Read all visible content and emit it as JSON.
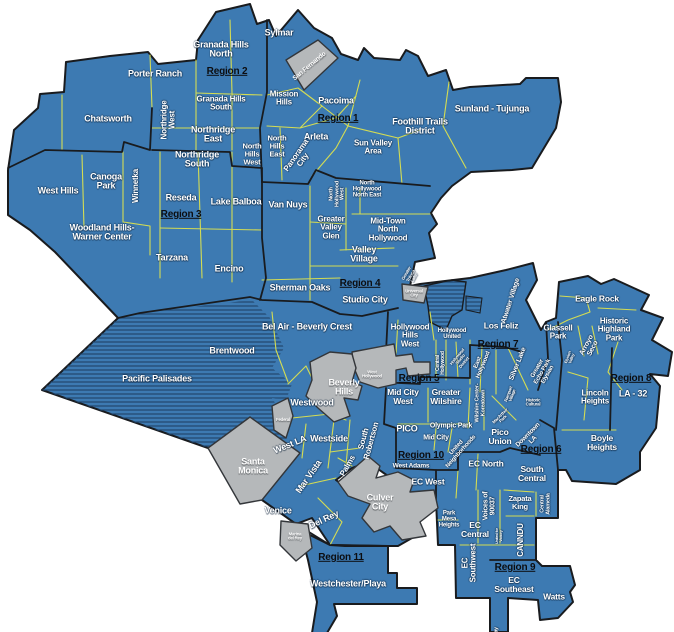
{
  "map": {
    "title": "Los Angeles Neighborhood Councils Region Map",
    "colors": {
      "land": "#3d7ab2",
      "hatch_line": "#22466d",
      "city_boundary": "#191b1e",
      "council_line": "#dde24e",
      "other_city_fill": "#b5b8ba",
      "other_city_stroke": "#33363a",
      "area_label": "#ffffff",
      "region_label": "#0c0d10"
    },
    "labels": [
      {
        "id": "sylmar",
        "text": "Sylmar",
        "x": 279,
        "y": 33,
        "rot": 0,
        "size": 9,
        "style": "area"
      },
      {
        "id": "granada-hills-north",
        "text": "Granada Hills\nNorth",
        "x": 221,
        "y": 50,
        "rot": 0,
        "size": 9,
        "style": "area"
      },
      {
        "id": "region-2",
        "text": "Region 2",
        "x": 227,
        "y": 72,
        "rot": 0,
        "size": 10,
        "style": "region"
      },
      {
        "id": "porter-ranch",
        "text": "Porter Ranch",
        "x": 155,
        "y": 74,
        "rot": 0,
        "size": 9,
        "style": "area"
      },
      {
        "id": "granada-hills-south",
        "text": "Granada Hills\nSouth",
        "x": 221,
        "y": 104,
        "rot": 0,
        "size": 8,
        "style": "area"
      },
      {
        "id": "mission-hills",
        "text": "Mission\nHills",
        "x": 284,
        "y": 99,
        "rot": 0,
        "size": 8,
        "style": "area"
      },
      {
        "id": "chatsworth",
        "text": "Chatsworth",
        "x": 108,
        "y": 119,
        "rot": 0,
        "size": 9,
        "style": "area"
      },
      {
        "id": "northridge-west",
        "text": "Northridge\nWest",
        "x": 169,
        "y": 120,
        "rot": -90,
        "size": 8,
        "style": "area"
      },
      {
        "id": "northridge-east",
        "text": "Northridge\nEast",
        "x": 213,
        "y": 135,
        "rot": 0,
        "size": 9,
        "style": "area"
      },
      {
        "id": "northridge-south",
        "text": "Northridge\nSouth",
        "x": 197,
        "y": 160,
        "rot": 0,
        "size": 9,
        "style": "area"
      },
      {
        "id": "north-hills-west",
        "text": "North\nHills\nWest",
        "x": 252,
        "y": 154,
        "rot": 0,
        "size": 7.5,
        "style": "area"
      },
      {
        "id": "north-hills-east",
        "text": "North\nHills\nEast",
        "x": 277,
        "y": 146,
        "rot": 0,
        "size": 7.5,
        "style": "area"
      },
      {
        "id": "arleta",
        "text": "Arleta",
        "x": 316,
        "y": 137,
        "rot": 0,
        "size": 9,
        "style": "area"
      },
      {
        "id": "panorama-city",
        "text": "Panorama\nCity",
        "x": 300,
        "y": 158,
        "rot": -55,
        "size": 8,
        "style": "area"
      },
      {
        "id": "pacoima",
        "text": "Pacoima",
        "x": 336,
        "y": 101,
        "rot": 0,
        "size": 9,
        "style": "area"
      },
      {
        "id": "region-1",
        "text": "Region 1",
        "x": 338,
        "y": 119,
        "rot": 0,
        "size": 10,
        "style": "region"
      },
      {
        "id": "sun-valley-area",
        "text": "Sun Valley\nArea",
        "x": 373,
        "y": 148,
        "rot": 0,
        "size": 8,
        "style": "area"
      },
      {
        "id": "foothill-trails-district",
        "text": "Foothill Trails\nDistrict",
        "x": 420,
        "y": 127,
        "rot": 0,
        "size": 9,
        "style": "area"
      },
      {
        "id": "sunland-tujunga",
        "text": "Sunland - Tujunga",
        "x": 492,
        "y": 109,
        "rot": 0,
        "size": 9,
        "style": "area"
      },
      {
        "id": "san-fernando",
        "text": "San Fernando",
        "x": 310,
        "y": 67,
        "rot": -40,
        "size": 6.5,
        "style": "city"
      },
      {
        "id": "west-hills",
        "text": "West Hills",
        "x": 58,
        "y": 191,
        "rot": 0,
        "size": 9,
        "style": "area"
      },
      {
        "id": "canoga-park",
        "text": "Canoga\nPark",
        "x": 106,
        "y": 182,
        "rot": 0,
        "size": 9,
        "style": "area"
      },
      {
        "id": "winnetka",
        "text": "Winnetka",
        "x": 136,
        "y": 186,
        "rot": -90,
        "size": 8,
        "style": "area"
      },
      {
        "id": "reseda",
        "text": "Reseda",
        "x": 181,
        "y": 198,
        "rot": 0,
        "size": 9,
        "style": "area"
      },
      {
        "id": "region-3",
        "text": "Region 3",
        "x": 181,
        "y": 215,
        "rot": 0,
        "size": 10,
        "style": "region"
      },
      {
        "id": "lake-balboa",
        "text": "Lake Balboa",
        "x": 236,
        "y": 202,
        "rot": 0,
        "size": 9,
        "style": "area"
      },
      {
        "id": "van-nuys",
        "text": "Van Nuys",
        "x": 288,
        "y": 205,
        "rot": 0,
        "size": 9,
        "style": "area"
      },
      {
        "id": "woodland-hills-warner-center",
        "text": "Woodland Hills-\nWarner Center",
        "x": 102,
        "y": 233,
        "rot": 0,
        "size": 9,
        "style": "area"
      },
      {
        "id": "tarzana",
        "text": "Tarzana",
        "x": 172,
        "y": 258,
        "rot": 0,
        "size": 9,
        "style": "area"
      },
      {
        "id": "encino",
        "text": "Encino",
        "x": 229,
        "y": 269,
        "rot": 0,
        "size": 9,
        "style": "area"
      },
      {
        "id": "north-hollywood-west",
        "text": "North\nHollywood\nWest",
        "x": 338,
        "y": 194,
        "rot": -90,
        "size": 5.5,
        "style": "area"
      },
      {
        "id": "north-hollywood-north-east",
        "text": "North\nHollywood\nNorth East",
        "x": 367,
        "y": 190,
        "rot": 0,
        "size": 6,
        "style": "area"
      },
      {
        "id": "greater-valley-glen",
        "text": "Greater\nValley\nGlen",
        "x": 331,
        "y": 228,
        "rot": 0,
        "size": 8,
        "style": "area"
      },
      {
        "id": "mid-town-north-hollywood",
        "text": "Mid-Town\nNorth\nHollywood",
        "x": 388,
        "y": 230,
        "rot": 0,
        "size": 8,
        "style": "area"
      },
      {
        "id": "valley-village",
        "text": "Valley\nVillage",
        "x": 364,
        "y": 255,
        "rot": 0,
        "size": 9,
        "style": "area"
      },
      {
        "id": "region-4",
        "text": "Region 4",
        "x": 360,
        "y": 284,
        "rot": 0,
        "size": 10,
        "style": "region"
      },
      {
        "id": "studio-city",
        "text": "Studio City",
        "x": 365,
        "y": 300,
        "rot": 0,
        "size": 9,
        "style": "area"
      },
      {
        "id": "sherman-oaks",
        "text": "Sherman Oaks",
        "x": 300,
        "y": 288,
        "rot": 0,
        "size": 9,
        "style": "area"
      },
      {
        "id": "greater-toluca-lake",
        "text": "Greater\nToluca\nLake",
        "x": 411,
        "y": 276,
        "rot": -60,
        "size": 4.5,
        "style": "area"
      },
      {
        "id": "universal-city",
        "text": "Universal\nCity",
        "x": 414,
        "y": 294,
        "rot": 0,
        "size": 4.3,
        "style": "city"
      },
      {
        "id": "bel-air-beverly-crest",
        "text": "Bel Air - Beverly Crest",
        "x": 307,
        "y": 327,
        "rot": 0,
        "size": 9,
        "style": "area"
      },
      {
        "id": "brentwood",
        "text": "Brentwood",
        "x": 232,
        "y": 351,
        "rot": 0,
        "size": 9,
        "style": "area"
      },
      {
        "id": "pacific-palisades",
        "text": "Pacific Palisades",
        "x": 157,
        "y": 379,
        "rot": 0,
        "size": 9,
        "style": "area"
      },
      {
        "id": "westwood",
        "text": "Westwood",
        "x": 312,
        "y": 403,
        "rot": 0,
        "size": 9,
        "style": "area"
      },
      {
        "id": "beverly-hills",
        "text": "Beverly\nHills",
        "x": 344,
        "y": 388,
        "rot": 0,
        "size": 9,
        "style": "city"
      },
      {
        "id": "west-hollywood",
        "text": "West\nHollywood",
        "x": 372,
        "y": 375,
        "rot": 0,
        "size": 4.3,
        "style": "city"
      },
      {
        "id": "federal",
        "text": "Federal",
        "x": 283,
        "y": 420,
        "rot": 0,
        "size": 4.3,
        "style": "city"
      },
      {
        "id": "westside",
        "text": "Westside",
        "x": 329,
        "y": 439,
        "rot": 0,
        "size": 9,
        "style": "area"
      },
      {
        "id": "west-la",
        "text": "West LA",
        "x": 290,
        "y": 445,
        "rot": -22,
        "size": 9,
        "style": "area"
      },
      {
        "id": "mar-vista",
        "text": "Mar Vista",
        "x": 309,
        "y": 477,
        "rot": -55,
        "size": 9,
        "style": "area"
      },
      {
        "id": "santa-monica",
        "text": "Santa\nMonica",
        "x": 253,
        "y": 467,
        "rot": 0,
        "size": 9,
        "style": "city"
      },
      {
        "id": "south-robertson",
        "text": "South\nRobertson",
        "x": 368,
        "y": 440,
        "rot": -75,
        "size": 8,
        "style": "area"
      },
      {
        "id": "palms",
        "text": "Palms",
        "x": 348,
        "y": 466,
        "rot": -60,
        "size": 8,
        "style": "area"
      },
      {
        "id": "venice",
        "text": "Venice",
        "x": 278,
        "y": 511,
        "rot": 0,
        "size": 9,
        "style": "area"
      },
      {
        "id": "del-rey",
        "text": "Del Rey",
        "x": 324,
        "y": 520,
        "rot": -25,
        "size": 9,
        "style": "area"
      },
      {
        "id": "marina-del-rey",
        "text": "Marina\ndel Rey",
        "x": 295,
        "y": 537,
        "rot": 0,
        "size": 4.3,
        "style": "city"
      },
      {
        "id": "culver-city",
        "text": "Culver\nCity",
        "x": 380,
        "y": 503,
        "rot": 0,
        "size": 9,
        "style": "city"
      },
      {
        "id": "region-11",
        "text": "Region 11",
        "x": 341,
        "y": 558,
        "rot": 0,
        "size": 10,
        "style": "region"
      },
      {
        "id": "westchester-playa",
        "text": "Westchester/Playa",
        "x": 348,
        "y": 584,
        "rot": 0,
        "size": 9,
        "style": "area"
      },
      {
        "id": "hollywood-hills-west",
        "text": "Hollywood\nHills\nWest",
        "x": 410,
        "y": 336,
        "rot": 0,
        "size": 8,
        "style": "area"
      },
      {
        "id": "hollywood-united",
        "text": "Hollywood\nUnited",
        "x": 452,
        "y": 334,
        "rot": 0,
        "size": 6,
        "style": "area"
      },
      {
        "id": "los-feliz",
        "text": "Los Feliz",
        "x": 501,
        "y": 326,
        "rot": 0,
        "size": 8.5,
        "style": "area"
      },
      {
        "id": "region-7",
        "text": "Region 7",
        "x": 498,
        "y": 345,
        "rot": 0,
        "size": 10,
        "style": "region"
      },
      {
        "id": "central-hollywood",
        "text": "Central\nHollywood",
        "x": 441,
        "y": 363,
        "rot": -90,
        "size": 5,
        "style": "area"
      },
      {
        "id": "hollywood-studio-district",
        "text": "Hollywood\nStudio\nDistrict",
        "x": 461,
        "y": 360,
        "rot": -50,
        "size": 4.3,
        "style": "area"
      },
      {
        "id": "east-hollywood",
        "text": "East\nHollywood",
        "x": 481,
        "y": 364,
        "rot": -68,
        "size": 6,
        "style": "area"
      },
      {
        "id": "silver-lake",
        "text": "Silver Lake",
        "x": 518,
        "y": 364,
        "rot": -68,
        "size": 7,
        "style": "area"
      },
      {
        "id": "greater-echo-park-elysian",
        "text": "Greater\nEcho Park\nElysian",
        "x": 543,
        "y": 372,
        "rot": -60,
        "size": 6,
        "style": "area"
      },
      {
        "id": "elysian-valley",
        "text": "Elysian\nValley",
        "x": 570,
        "y": 358,
        "rot": -70,
        "size": 4,
        "style": "area"
      },
      {
        "id": "atwater-village",
        "text": "Atwater Village",
        "x": 511,
        "y": 301,
        "rot": -72,
        "size": 7,
        "style": "area"
      },
      {
        "id": "glassell-park",
        "text": "Glassell\nPark",
        "x": 558,
        "y": 333,
        "rot": 0,
        "size": 8,
        "style": "area"
      },
      {
        "id": "arroyo-seco",
        "text": "Arroyo\nSeco",
        "x": 590,
        "y": 347,
        "rot": -62,
        "size": 7,
        "style": "area"
      },
      {
        "id": "eagle-rock",
        "text": "Eagle Rock",
        "x": 597,
        "y": 299,
        "rot": 0,
        "size": 8.5,
        "style": "area"
      },
      {
        "id": "historic-highland-park",
        "text": "Historic\nHighland\nPark",
        "x": 614,
        "y": 330,
        "rot": 0,
        "size": 8,
        "style": "area"
      },
      {
        "id": "region-8",
        "text": "Region 8",
        "x": 631,
        "y": 379,
        "rot": 0,
        "size": 10,
        "style": "region"
      },
      {
        "id": "la-32",
        "text": "LA - 32",
        "x": 633,
        "y": 394,
        "rot": 0,
        "size": 9,
        "style": "area"
      },
      {
        "id": "lincoln-heights",
        "text": "Lincoln\nHeights",
        "x": 595,
        "y": 398,
        "rot": 0,
        "size": 8,
        "style": "area"
      },
      {
        "id": "boyle-heights",
        "text": "Boyle\nHeights",
        "x": 602,
        "y": 443,
        "rot": 0,
        "size": 8.5,
        "style": "area"
      },
      {
        "id": "region-5",
        "text": "Region 5",
        "x": 419,
        "y": 379,
        "rot": 0,
        "size": 10,
        "style": "region"
      },
      {
        "id": "mid-city-west",
        "text": "Mid City\nWest",
        "x": 403,
        "y": 397,
        "rot": 0,
        "size": 8.5,
        "style": "area"
      },
      {
        "id": "greater-wilshire",
        "text": "Greater\nWilshire",
        "x": 446,
        "y": 397,
        "rot": 0,
        "size": 8.5,
        "style": "area"
      },
      {
        "id": "wilshire-center-koreatown",
        "text": "Wilshire Center-\nKoreatown",
        "x": 481,
        "y": 403,
        "rot": -90,
        "size": 5.5,
        "style": "area"
      },
      {
        "id": "pico",
        "text": "PICO",
        "x": 407,
        "y": 429,
        "rot": 0,
        "size": 9,
        "style": "area"
      },
      {
        "id": "olympic-park",
        "text": "Olympic Park",
        "x": 451,
        "y": 426,
        "rot": 0,
        "size": 7,
        "style": "area"
      },
      {
        "id": "mid-city",
        "text": "Mid City",
        "x": 436,
        "y": 438,
        "rot": 0,
        "size": 7,
        "style": "area"
      },
      {
        "id": "rampart-village",
        "text": "Rampart\nVillage",
        "x": 511,
        "y": 395,
        "rot": -70,
        "size": 4.3,
        "style": "area"
      },
      {
        "id": "macarthur-park",
        "text": "MacArthur\nPark",
        "x": 502,
        "y": 418,
        "rot": -45,
        "size": 4.3,
        "style": "area"
      },
      {
        "id": "historic-cultural",
        "text": "Historic\nCultural",
        "x": 533,
        "y": 403,
        "rot": 0,
        "size": 4.3,
        "style": "area"
      },
      {
        "id": "pico-union",
        "text": "Pico\nUnion",
        "x": 500,
        "y": 437,
        "rot": 0,
        "size": 8.5,
        "style": "area"
      },
      {
        "id": "downtown-la",
        "text": "Downtown\nLA",
        "x": 531,
        "y": 438,
        "rot": -45,
        "size": 6.5,
        "style": "area"
      },
      {
        "id": "region-6",
        "text": "Region 6",
        "x": 541,
        "y": 450,
        "rot": 0,
        "size": 10,
        "style": "region"
      },
      {
        "id": "region-10",
        "text": "Region 10",
        "x": 421,
        "y": 456,
        "rot": 0,
        "size": 10,
        "style": "region"
      },
      {
        "id": "west-adams",
        "text": "West Adams",
        "x": 411,
        "y": 467,
        "rot": 0,
        "size": 6.5,
        "style": "area"
      },
      {
        "id": "united-neighborhoods",
        "text": "United\nNeighborhoods",
        "x": 459,
        "y": 450,
        "rot": -48,
        "size": 6,
        "style": "area"
      },
      {
        "id": "ec-west",
        "text": "EC West",
        "x": 428,
        "y": 482,
        "rot": 0,
        "size": 8.5,
        "style": "area"
      },
      {
        "id": "ec-north",
        "text": "EC North",
        "x": 486,
        "y": 464,
        "rot": 0,
        "size": 8.5,
        "style": "area"
      },
      {
        "id": "south-central",
        "text": "South\nCentral",
        "x": 532,
        "y": 474,
        "rot": 0,
        "size": 8.5,
        "style": "area"
      },
      {
        "id": "voices-of-90037",
        "text": "Voices of\n90037",
        "x": 490,
        "y": 506,
        "rot": -90,
        "size": 7,
        "style": "area"
      },
      {
        "id": "zapata-king",
        "text": "Zapata\nKing",
        "x": 520,
        "y": 503,
        "rot": 0,
        "size": 7.5,
        "style": "area"
      },
      {
        "id": "central-alameda",
        "text": "Central\nAlameda",
        "x": 546,
        "y": 504,
        "rot": -90,
        "size": 5.5,
        "style": "area"
      },
      {
        "id": "park-mesa-heights",
        "text": "Park\nMesa\nHeights",
        "x": 449,
        "y": 520,
        "rot": 0,
        "size": 6,
        "style": "area"
      },
      {
        "id": "ec-central",
        "text": "EC\nCentral",
        "x": 475,
        "y": 530,
        "rot": 0,
        "size": 8.5,
        "style": "area"
      },
      {
        "id": "ec-southwest",
        "text": "EC\nSouthwest",
        "x": 470,
        "y": 563,
        "rot": -90,
        "size": 8,
        "style": "area"
      },
      {
        "id": "united-for-victory",
        "text": "United for\nVictory",
        "x": 500,
        "y": 536,
        "rot": -90,
        "size": 3.8,
        "style": "area"
      },
      {
        "id": "canndu",
        "text": "CANNDU",
        "x": 521,
        "y": 540,
        "rot": -90,
        "size": 8,
        "style": "area"
      },
      {
        "id": "region-9",
        "text": "Region 9",
        "x": 515,
        "y": 568,
        "rot": 0,
        "size": 10,
        "style": "region"
      },
      {
        "id": "ec-southeast",
        "text": "EC\nSoutheast",
        "x": 514,
        "y": 585,
        "rot": 0,
        "size": 8.5,
        "style": "area"
      },
      {
        "id": "watts",
        "text": "Watts",
        "x": 554,
        "y": 597,
        "rot": 0,
        "size": 8.5,
        "style": "area"
      },
      {
        "id": "harbor-gateway",
        "text": "Harbor Gateway",
        "x": 497,
        "y": 645,
        "rot": -90,
        "size": 5,
        "style": "area"
      }
    ]
  }
}
